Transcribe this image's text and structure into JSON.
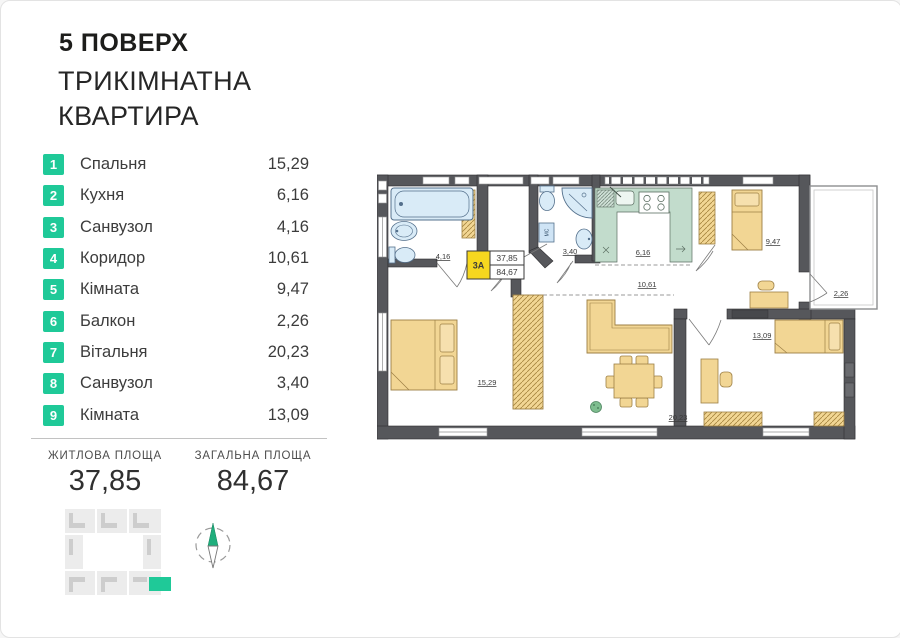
{
  "header": {
    "floor_title": "5 ПОВЕРХ",
    "subtitle_line1": "ТРИКІМНАТНА",
    "subtitle_line2": "КВАРТИРА"
  },
  "room_list": [
    {
      "num": "1",
      "name": "Спальня",
      "area": "15,29"
    },
    {
      "num": "2",
      "name": "Кухня",
      "area": "6,16"
    },
    {
      "num": "3",
      "name": "Санвузол",
      "area": "4,16"
    },
    {
      "num": "4",
      "name": "Коридор",
      "area": "10,61"
    },
    {
      "num": "5",
      "name": "Кімната",
      "area": "9,47"
    },
    {
      "num": "6",
      "name": "Балкон",
      "area": "2,26"
    },
    {
      "num": "7",
      "name": "Вітальня",
      "area": "20,23"
    },
    {
      "num": "8",
      "name": "Санвузол",
      "area": "3,40"
    },
    {
      "num": "9",
      "name": "Кімната",
      "area": "13,09"
    }
  ],
  "summary": {
    "living_label": "ЖИТЛОВА ПЛОЩА",
    "living_value": "37,85",
    "total_label": "ЗАГАЛЬНА ПЛОЩА",
    "total_value": "84,67"
  },
  "plan": {
    "unit_code": "3А",
    "living_area": "37,85",
    "total_area": "84,67",
    "labels": {
      "bath_small": "4,16",
      "bath_large": "3,40",
      "kitchen": "6,16",
      "corridor": "10,61",
      "bedroom2": "9,47",
      "balcony": "2,26",
      "bedroom1": "15,29",
      "living_room": "20,23",
      "bedroom3": "13,09",
      "washer": "МС"
    }
  },
  "colors": {
    "accent_green": "#1fc998",
    "badge_yellow": "#f6d71f",
    "wall_gray": "#56575b",
    "furniture_tan": "#f2d694",
    "plumbing_blue": "#d9ebf7",
    "kitchen_green": "#c2dccc"
  }
}
